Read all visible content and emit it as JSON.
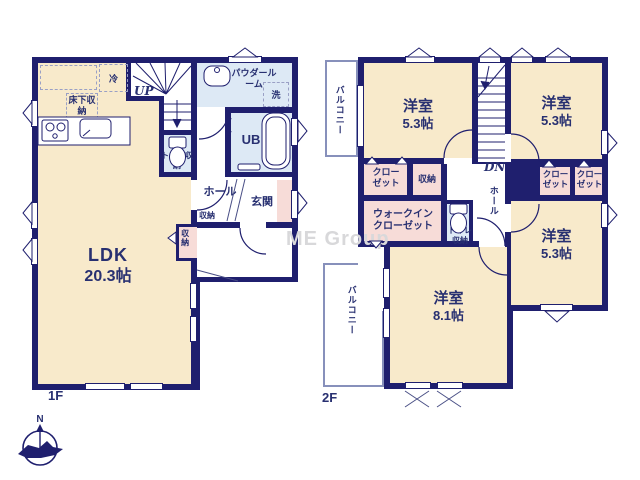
{
  "watermark": "ME Group",
  "compass": {
    "north": "N"
  },
  "colors": {
    "wall": "#1f1f6e",
    "room_cream": "#f8eacb",
    "closet_pink": "#f7dcd8",
    "wet_area_blue": "#dde9f5",
    "text_navy": "#283071",
    "watermark_gray": "#d8d8da",
    "balcony_border": "#8790bb"
  },
  "floor1": {
    "label": "1F",
    "ldk_name": "LDK",
    "ldk_size": "20.3帖",
    "up": "UP",
    "refrigerator": "冷",
    "underfloor_storage": "床下収納",
    "powder_room": "パウダールーム",
    "washer": "洗",
    "unit_bath": "UB",
    "toilet_storage": "トイレ収納",
    "hall": "ホール",
    "hall_storage": "収納",
    "genkan": "玄関",
    "ldk_storage": "収納"
  },
  "floor2": {
    "label": "2F",
    "dn": "DN",
    "balcony_top": "バルコニー",
    "balcony_bottom": "バルコニー",
    "room_nw_name": "洋室",
    "room_nw_size": "5.3帖",
    "room_ne_name": "洋室",
    "room_ne_size": "5.3帖",
    "room_se_name": "洋室",
    "room_se_size": "5.3帖",
    "room_s_name": "洋室",
    "room_s_size": "8.1帖",
    "closet_w": "クローゼット",
    "storage": "収納",
    "walk_in_closet": "ウォークインクローゼット",
    "toilet_storage": "トイレ収納",
    "hall": "ホール",
    "closet_e1": "クローゼット",
    "closet_e2": "クローゼット"
  }
}
